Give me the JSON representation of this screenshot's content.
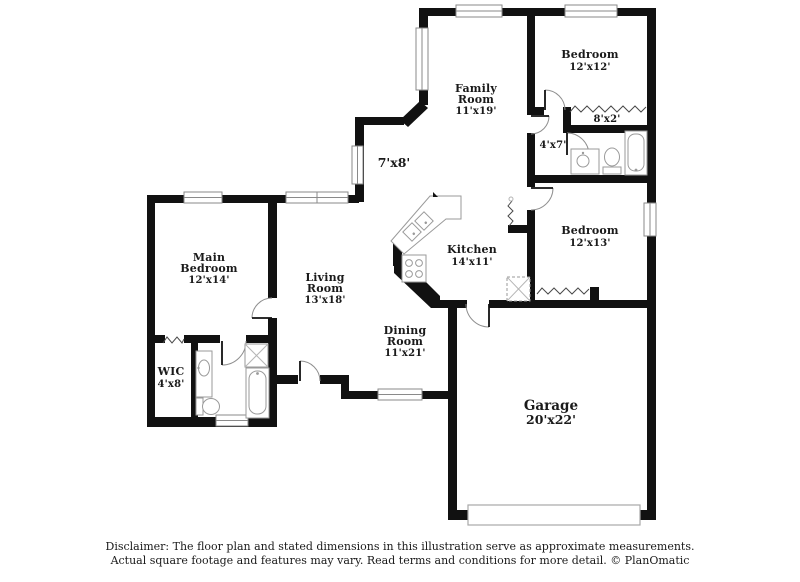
{
  "title": "Floor plan",
  "colors": {
    "wall": "#111111",
    "label_text": "#1a1a1a",
    "window_outline": "#8a8a8a",
    "fixture_outline": "#9a9a9a",
    "background": "#ffffff"
  },
  "rooms": {
    "family_room": {
      "line1": "Family",
      "line2": "Room",
      "dims": "11'x19'"
    },
    "bedroom_top": {
      "line1": "Bedroom",
      "dims": "12'x12'"
    },
    "closet_8x2": {
      "dims": "8'x2'"
    },
    "hall_4x7": {
      "dims": "4'x7'"
    },
    "nook_7x8": {
      "dims": "7'x8'"
    },
    "main_bedroom": {
      "line1": "Main",
      "line2": "Bedroom",
      "dims": "12'x14'"
    },
    "living_room": {
      "line1": "Living",
      "line2": "Room",
      "dims": "13'x18'"
    },
    "kitchen": {
      "line1": "Kitchen",
      "dims": "14'x11'"
    },
    "bedroom_right": {
      "line1": "Bedroom",
      "dims": "12'x13'"
    },
    "dining_room": {
      "line1": "Dining",
      "line2": "Room",
      "dims": "11'x21'"
    },
    "wic": {
      "line1": "WIC",
      "dims": "4'x8'"
    },
    "garage": {
      "line1": "Garage",
      "dims": "20'x22'"
    }
  },
  "disclaimer": {
    "line1": "Disclaimer: The floor plan and stated dimensions in this illustration serve as approximate measurements.",
    "line2": "Actual square footage and features may vary. Read terms and conditions for more detail. © PlanOmatic"
  }
}
